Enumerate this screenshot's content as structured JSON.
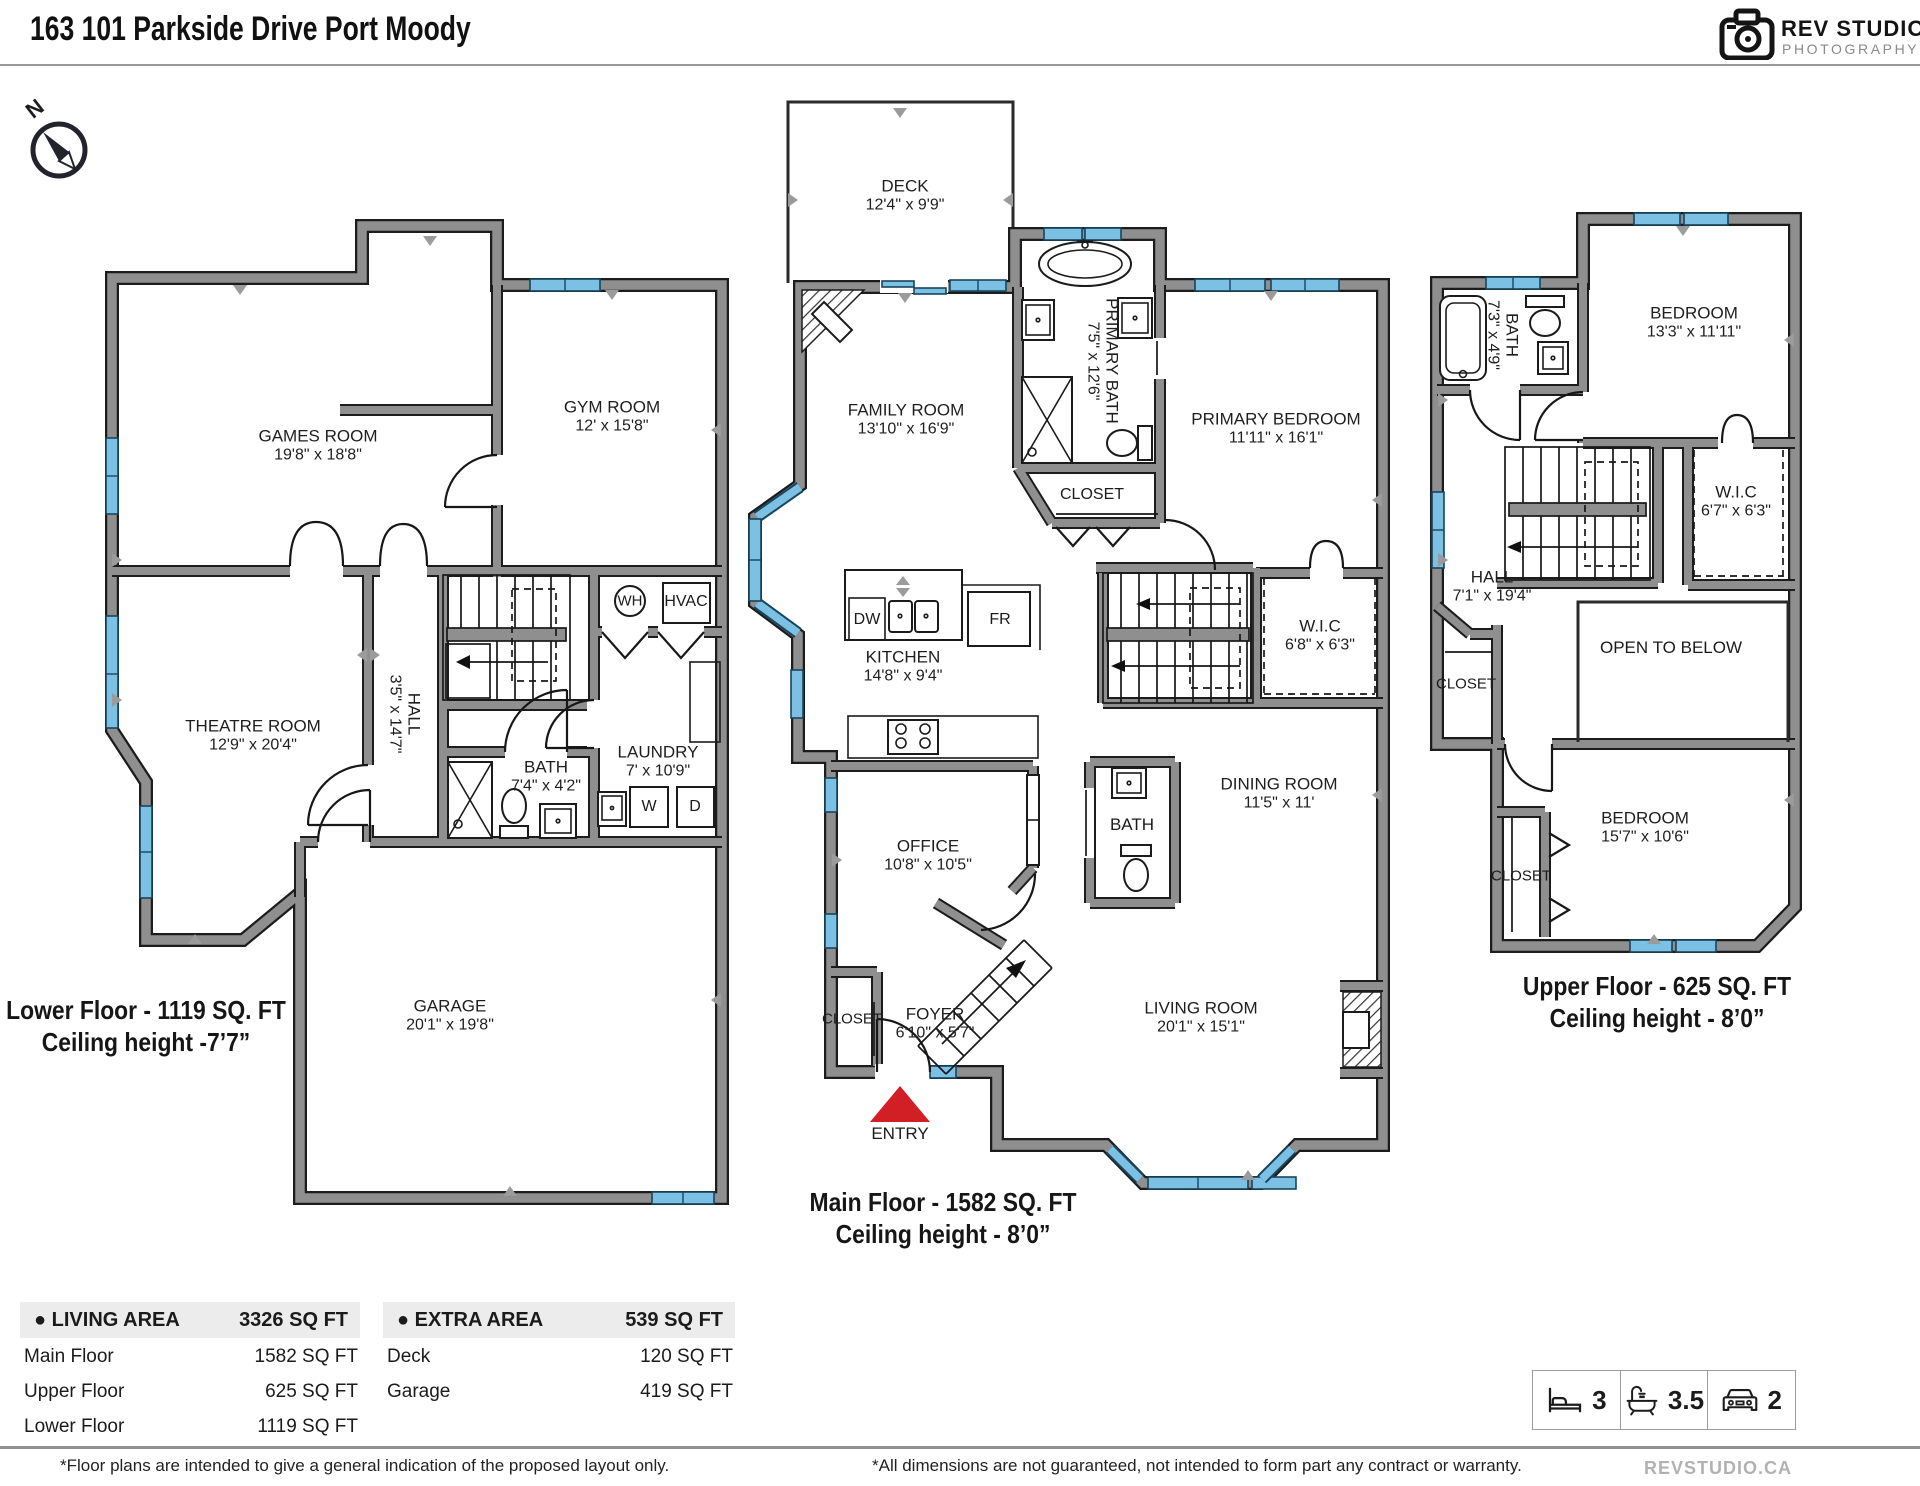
{
  "header": {
    "title": "163 101 Parkside Drive Port Moody",
    "logo": {
      "line1": "REV STUDIO",
      "line2": "PHOTOGRAPHY"
    }
  },
  "compass": {
    "north_label": "N"
  },
  "floors": {
    "lower": {
      "caption_line1": "Lower Floor - 1119 SQ. FT",
      "caption_line2": "Ceiling height -7’7”",
      "rooms": {
        "games": {
          "name": "GAMES ROOM",
          "dims": "19'8\" x 18'8\""
        },
        "gym": {
          "name": "GYM ROOM",
          "dims": "12' x 15'8\""
        },
        "theatre": {
          "name": "THEATRE ROOM",
          "dims": "12'9\" x 20'4\""
        },
        "hall": {
          "name": "HALL",
          "dims": "3'5\" x 14'7\""
        },
        "bath": {
          "name": "BATH",
          "dims": "7'4\" x 4'2\""
        },
        "laundry": {
          "name": "LAUNDRY",
          "dims": "7' x 10'9\""
        },
        "garage": {
          "name": "GARAGE",
          "dims": "20'1\" x 19'8\""
        }
      },
      "fixtures": {
        "wh": "WH",
        "hvac": "HVAC",
        "washer": "W",
        "dryer": "D"
      }
    },
    "main": {
      "caption_line1": "Main Floor - 1582 SQ. FT",
      "caption_line2": "Ceiling height - 8’0”",
      "rooms": {
        "deck": {
          "name": "DECK",
          "dims": "12'4\" x 9'9\""
        },
        "family": {
          "name": "FAMILY ROOM",
          "dims": "13'10\" x 16'9\""
        },
        "kitchen": {
          "name": "KITCHEN",
          "dims": "14'8\" x 9'4\""
        },
        "primary_bath": {
          "name": "PRIMARY BATH",
          "dims": "7'5\" x 12'6\""
        },
        "closet_bath": {
          "name": "CLOSET"
        },
        "primary_bedroom": {
          "name": "PRIMARY BEDROOM",
          "dims": "11'11\" x 16'1\""
        },
        "wic": {
          "name": "W.I.C",
          "dims": "6'8\" x 6'3\""
        },
        "dining": {
          "name": "DINING ROOM",
          "dims": "11'5\" x 11'"
        },
        "bath": {
          "name": "BATH"
        },
        "office": {
          "name": "OFFICE",
          "dims": "10'8\" x 10'5\""
        },
        "closet_foyer": {
          "name": "CLOSET"
        },
        "foyer": {
          "name": "FOYER",
          "dims": "6'10\" x 5'7\""
        },
        "living": {
          "name": "LIVING ROOM",
          "dims": "20'1\" x 15'1\""
        },
        "entry": {
          "name": "ENTRY"
        }
      },
      "fixtures": {
        "dw": "DW",
        "fr": "FR"
      }
    },
    "upper": {
      "caption_line1": "Upper Floor - 625 SQ. FT",
      "caption_line2": "Ceiling height - 8’0”",
      "rooms": {
        "bath": {
          "name": "BATH",
          "dims": "7'3\" x 4'9\""
        },
        "bedroom1": {
          "name": "BEDROOM",
          "dims": "13'3\" x 11'11\""
        },
        "wic": {
          "name": "W.I.C",
          "dims": "6'7\" x 6'3\""
        },
        "hall": {
          "name": "HALL",
          "dims": "7'1\" x 19'4\""
        },
        "open_below": {
          "name": "OPEN TO BELOW"
        },
        "closet_hall": {
          "name": "CLOSET"
        },
        "bedroom2": {
          "name": "BEDROOM",
          "dims": "15'7\" x 10'6\""
        },
        "closet_bed": {
          "name": "CLOSET"
        }
      }
    }
  },
  "tables": {
    "living": {
      "bullet": "●",
      "header": "LIVING AREA",
      "total": "3326 SQ FT",
      "rows": [
        {
          "label": "Main Floor",
          "value": "1582 SQ FT"
        },
        {
          "label": "Upper Floor",
          "value": "625 SQ FT"
        },
        {
          "label": "Lower Floor",
          "value": "1119 SQ FT"
        }
      ]
    },
    "extra": {
      "bullet": "●",
      "header": "EXTRA AREA",
      "total": "539 SQ FT",
      "rows": [
        {
          "label": "Deck",
          "value": "120 SQ FT"
        },
        {
          "label": "Garage",
          "value": "419 SQ FT"
        }
      ]
    }
  },
  "badges": {
    "beds": "3",
    "baths": "3.5",
    "parking": "2"
  },
  "footnotes": {
    "left": "*Floor plans are intended to give a general indication of the proposed layout only.",
    "center": "*All dimensions are not guaranteed, not intended to form part any contract or warranty."
  },
  "footer": {
    "website": "REVSTUDIO.CA"
  },
  "colors": {
    "accent_red": "#d21f26",
    "window_blue": "#7cc0e4",
    "wall_gray": "#8f8f8f"
  }
}
